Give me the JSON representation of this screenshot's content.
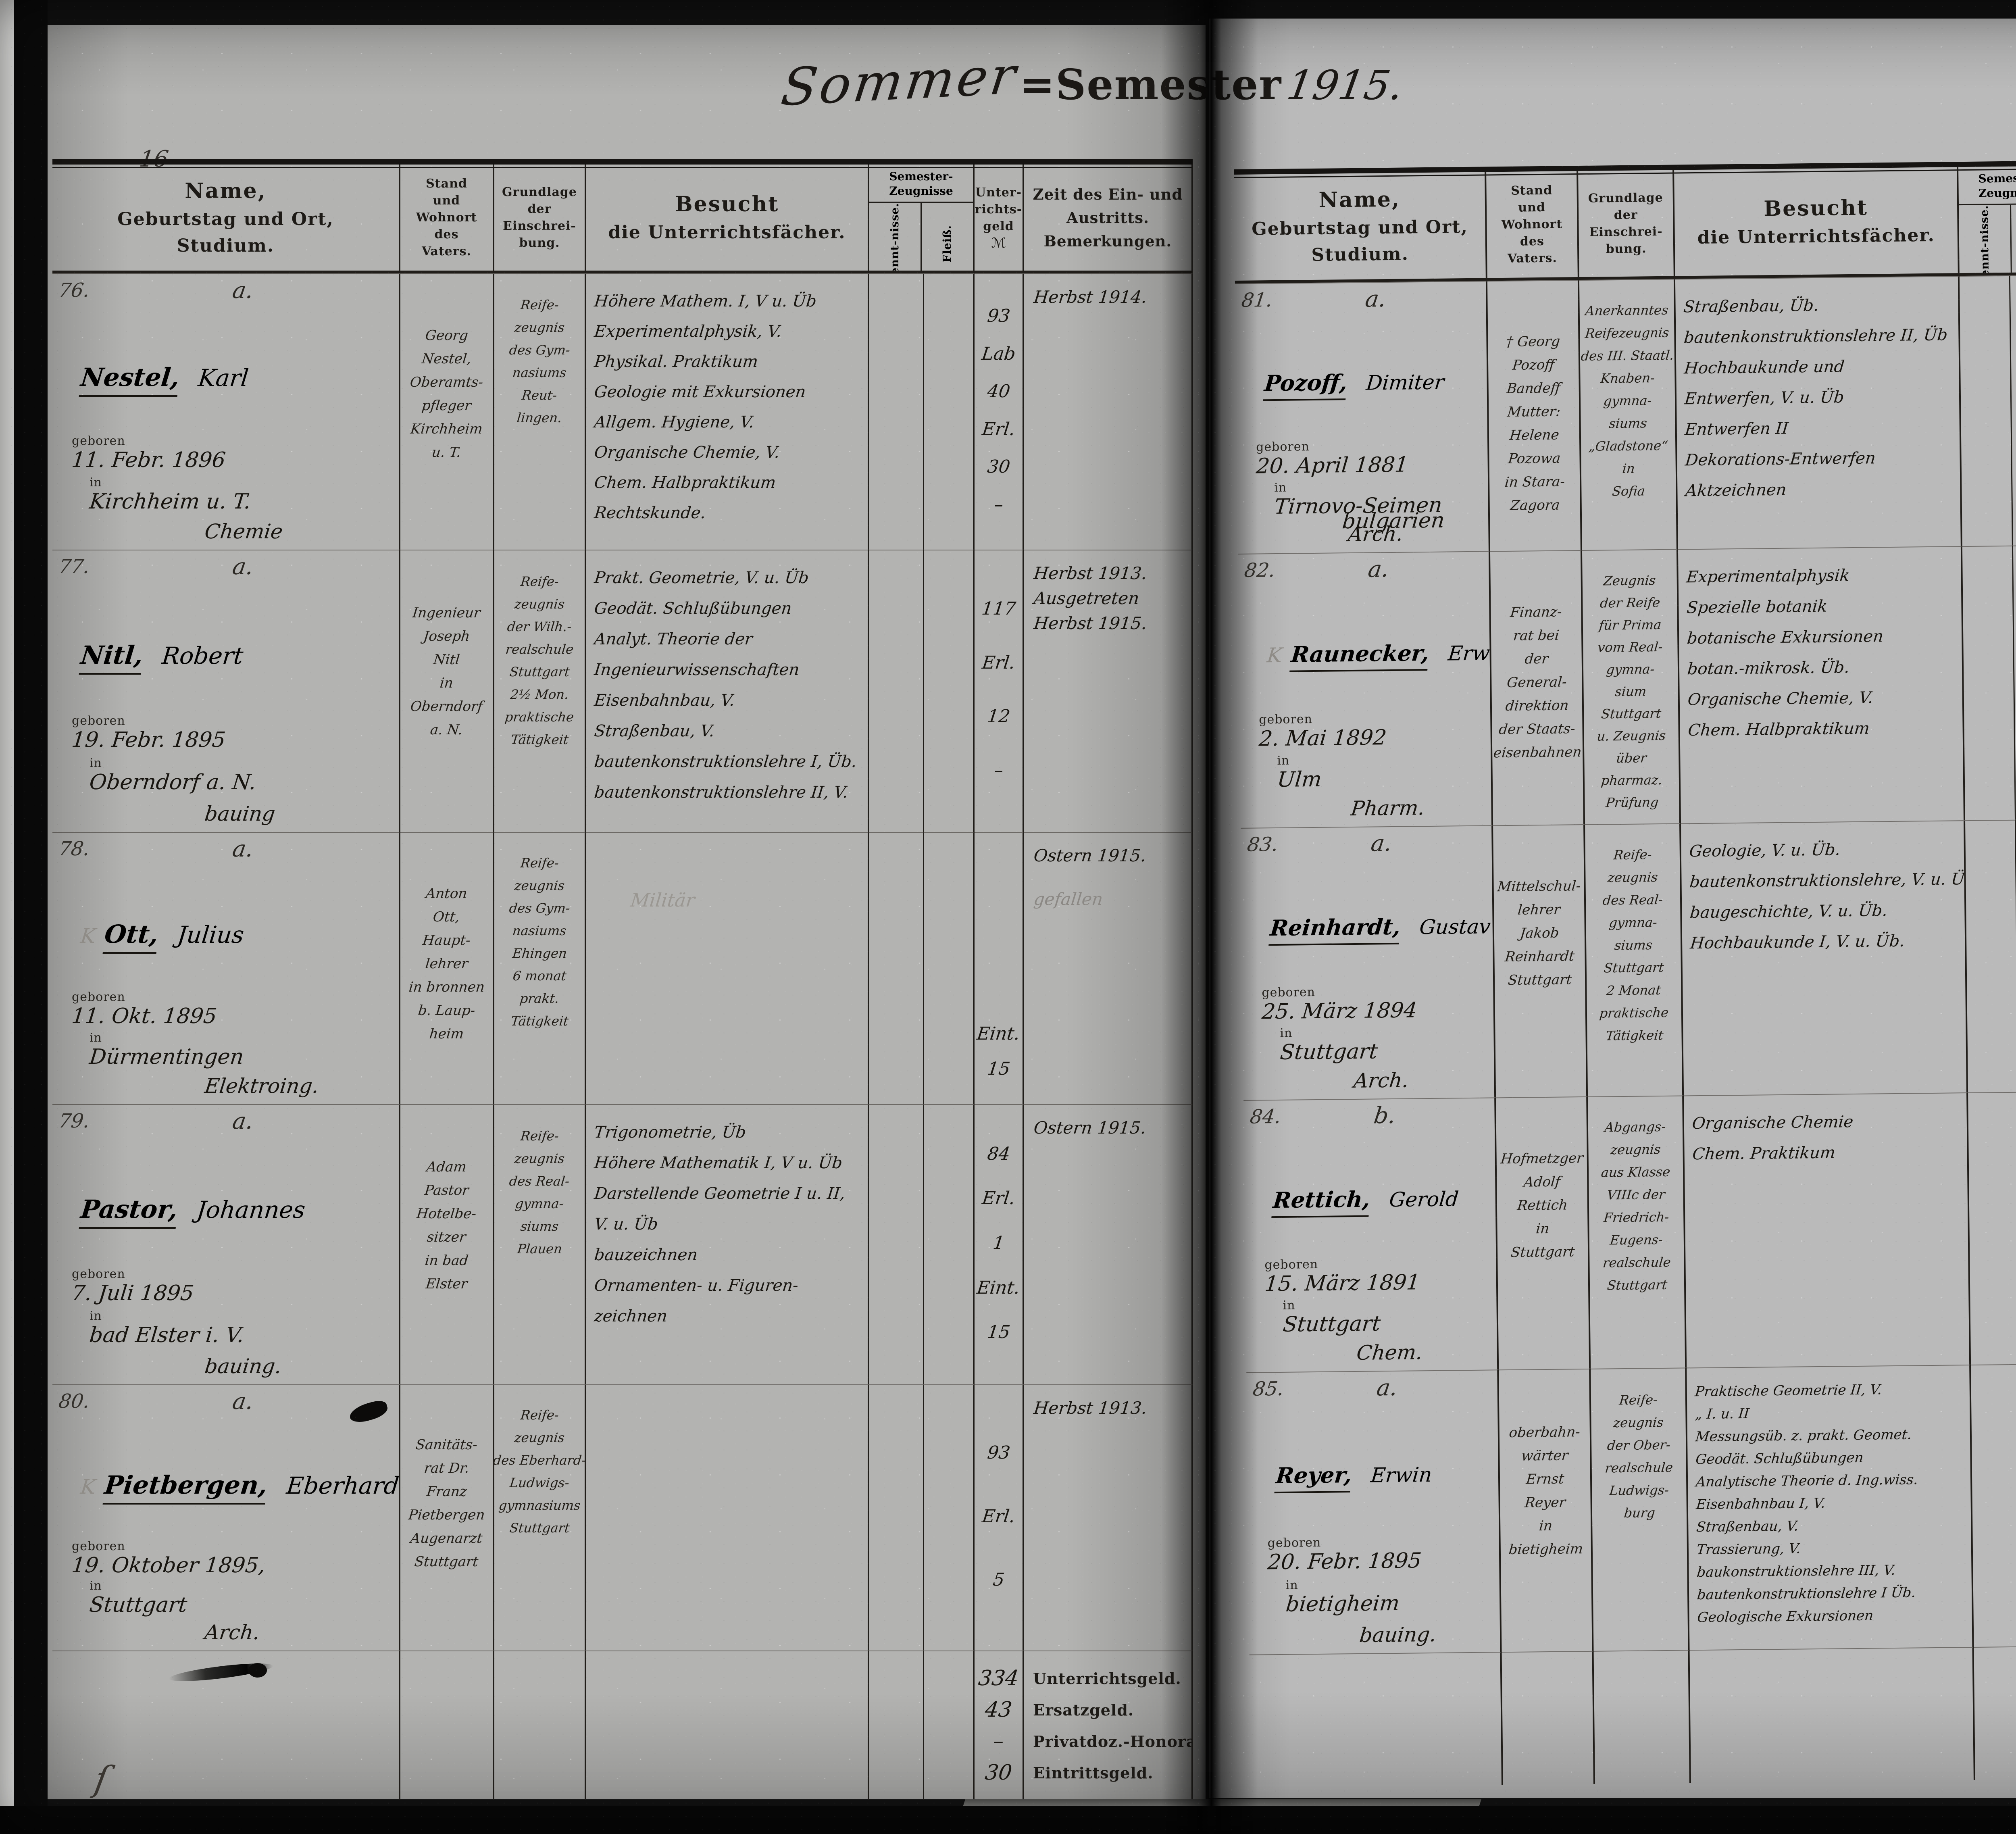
{
  "title": {
    "pre": "Sommer",
    "mid": "=Semester",
    "year": "1915."
  },
  "headers": {
    "name_lines": [
      "Name,",
      "Geburtstag und Ort,",
      "Studium."
    ],
    "stand_lines": [
      "Stand",
      "und",
      "Wohnort",
      "des",
      "Vaters."
    ],
    "grund_lines": [
      "Grundlage",
      "der",
      "Einschrei-",
      "bung."
    ],
    "besucht_lines": [
      "Besucht",
      "die Unterrichtsfächer."
    ],
    "zeug_lines": [
      "Semester-",
      "Zeugnisse"
    ],
    "kennt": "Kennt-nisse.",
    "fleiss": "Fleiß.",
    "geld_lines": [
      "Unter-",
      "richts-",
      "geld"
    ],
    "geld_currency": "ℳ",
    "zeit_lines": [
      "Zeit des Ein- und",
      "Austritts.",
      "Bemerkungen."
    ]
  },
  "pages": [
    {
      "page_number": "16",
      "entries": [
        {
          "number": "76.",
          "category": "a.",
          "surname": "Nestel,",
          "firstname": "Karl",
          "birth_label": "geboren",
          "birth_date": "11. Febr. 1896",
          "place_label": "in",
          "place": "Kirchheim u. T.",
          "study": "Chemie",
          "father": [
            "Georg",
            "Nestel,",
            "Oberamts-",
            "pfleger",
            "Kirchheim",
            "u. T."
          ],
          "grundlage": [
            "Reife-",
            "zeugnis",
            "des Gym-",
            "nasiums",
            "Reut-",
            "lingen."
          ],
          "subjects": [
            "Höhere Mathem. I, V u. Üb",
            "Experimentalphysik, V.",
            "Physikal. Praktikum",
            "Geologie mit Exkursionen",
            "Allgem. Hygiene, V.",
            "Organische Chemie, V.",
            "Chem. Halbpraktikum",
            "Rechtskunde."
          ],
          "fees": [
            {
              "t": "93"
            },
            {
              "t": "Lab"
            },
            {
              "t": "40"
            },
            {
              "t": "Erl."
            },
            {
              "t": "30"
            },
            {
              "t": "–"
            }
          ],
          "zeit": [
            {
              "t": "Herbst 1914."
            }
          ]
        },
        {
          "number": "77.",
          "category": "a.",
          "surname": "Nitl,",
          "firstname": "Robert",
          "birth_label": "geboren",
          "birth_date": "19. Febr. 1895",
          "place_label": "in",
          "place": "Oberndorf a. N.",
          "study": "bauing",
          "father": [
            "Ingenieur",
            "Joseph",
            "Nitl",
            "in",
            "Oberndorf",
            "a. N."
          ],
          "grundlage": [
            "Reife-",
            "zeugnis",
            "der Wilh.-",
            "realschule",
            "Stuttgart",
            "2½ Mon.",
            "praktische",
            "Tätigkeit"
          ],
          "subjects": [
            "Prakt. Geometrie, V. u. Üb",
            "Geodät. Schlußübungen",
            "Analyt. Theorie der",
            "Ingenieurwissenschaften",
            "Eisenbahnbau, V.",
            "Straßenbau, V.",
            "bautenkonstruktionslehre I, Üb.",
            "bautenkonstruktionslehre II, V."
          ],
          "fees": [
            {
              "t": "117"
            },
            {
              "t": "Erl."
            },
            {
              "t": "12"
            },
            {
              "t": "–"
            }
          ],
          "zeit": [
            {
              "t": "Herbst 1913."
            },
            {
              "t": "Ausgetreten"
            },
            {
              "t": "Herbst 1915."
            }
          ]
        },
        {
          "number": "78.",
          "category": "a.",
          "k_mark": "K",
          "surname": "Ott,",
          "firstname": "Julius",
          "birth_label": "geboren",
          "birth_date": "11. Okt. 1895",
          "place_label": "in",
          "place": "Dürmentingen",
          "study": "Elektroing.",
          "father": [
            "Anton",
            "Ott,",
            "Haupt-",
            "lehrer",
            "in bronnen",
            "b. Laup-",
            "heim"
          ],
          "grundlage": [
            "Reife-",
            "zeugnis",
            "des Gym-",
            "nasiums",
            "Ehingen",
            "6 monat",
            "prakt.",
            "Tätigkeit"
          ],
          "subjects": [],
          "subjects_pencil": "Militär",
          "fees": [
            {
              "t": "Eint."
            },
            {
              "t": "15"
            }
          ],
          "fees_justify": "flex-end",
          "zeit": [
            {
              "t": "Ostern 1915."
            },
            {
              "t": "gefallen",
              "pencil": true
            }
          ]
        },
        {
          "number": "79.",
          "category": "a.",
          "surname": "Pastor,",
          "firstname": "Johannes",
          "birth_label": "geboren",
          "birth_date": "7. Juli 1895",
          "place_label": "in",
          "place": "bad Elster i. V.",
          "study": "bauing.",
          "father": [
            "Adam",
            "Pastor",
            "Hotelbe-",
            "sitzer",
            "in bad",
            "Elster"
          ],
          "grundlage": [
            "Reife-",
            "zeugnis",
            "des Real-",
            "gymna-",
            "siums",
            "Plauen"
          ],
          "subjects": [
            "Trigonometrie, Üb",
            "Höhere Mathematik I, V u. Üb",
            "Darstellende Geometrie I u. II,",
            "V. u. Üb",
            "bauzeichnen",
            "Ornamenten- u. Figuren-",
            "zeichnen"
          ],
          "fees": [
            {
              "t": "84"
            },
            {
              "t": "Erl."
            },
            {
              "t": "1"
            },
            {
              "t": "Eint."
            },
            {
              "t": "15"
            }
          ],
          "zeit": [
            {
              "t": "Ostern 1915."
            }
          ]
        },
        {
          "number": "80.",
          "category": "a.",
          "k_mark": "K",
          "surname": "Pietbergen,",
          "firstname": "Eberhard",
          "birth_label": "geboren",
          "birth_date": "19. Oktober 1895,",
          "place_label": "in",
          "place": "Stuttgart",
          "study": "Arch.",
          "father": [
            "Sanitäts-",
            "rat Dr.",
            "Franz",
            "Pietbergen",
            "Augenarzt",
            "Stuttgart"
          ],
          "grundlage": [
            "Reife-",
            "zeugnis",
            "des Eberhard-",
            "Ludwigs-",
            "gymnasiums",
            "Stuttgart"
          ],
          "subjects": [],
          "fees": [
            {
              "t": "93"
            },
            {
              "t": "Erl."
            },
            {
              "t": "5"
            }
          ],
          "zeit": [
            {
              "t": "Herbst 1913."
            }
          ]
        }
      ],
      "totals": [
        {
          "amount": "334",
          "label": "Unterrichtsgeld."
        },
        {
          "amount": "43",
          "label": "Ersatzgeld."
        },
        {
          "amount": "–",
          "label": "Privatdoz.-Honorar."
        },
        {
          "amount": "30",
          "label": "Eintrittsgeld."
        }
      ]
    },
    {
      "page_number": "17",
      "entries": [
        {
          "number": "81.",
          "category": "a.",
          "surname": "Pozoff,",
          "firstname": "Dimiter",
          "birth_label": "geboren",
          "birth_date": "20. April 1881",
          "place_label": "in",
          "place": "Tirnovo-Seimen",
          "place2": "bulgarien",
          "study": "Arch.",
          "father": [
            "† Georg",
            "Pozoff",
            "Bandeff",
            "Mutter:",
            "Helene",
            "Pozowa",
            "in Stara-",
            "Zagora"
          ],
          "grundlage": [
            "Anerkanntes",
            "Reifezeugnis",
            "des III. Staatl.",
            "Knaben-",
            "gymna-",
            "siums",
            "„Gladstone“",
            "in",
            "Sofia"
          ],
          "subjects": [
            "Straßenbau, Üb.",
            "bautenkonstruktionslehre II, Üb",
            "Hochbaukunde und",
            "Entwerfen, V. u. Üb",
            "Entwerfen II",
            "Dekorations-Entwerfen",
            "Aktzeichnen"
          ],
          "fees": [
            {
              "t": "146"
            },
            {
              "t": "Erl."
            },
            {
              "t": "2"
            }
          ],
          "zeit": [
            {
              "t": "Herbst 1910/12;"
            },
            {
              "t": "wieder"
            },
            {
              "t": "Herbst 1913."
            },
            {
              "t": "Ausgetreten"
            },
            {
              "t": "Herbst 1915"
            }
          ]
        },
        {
          "number": "82.",
          "category": "a.",
          "k_mark": "K",
          "surname": "Raunecker,",
          "firstname": "Erwin",
          "birth_label": "geboren",
          "birth_date": "2. Mai 1892",
          "place_label": "in",
          "place": "Ulm",
          "study": "Pharm.",
          "father": [
            "Finanz-",
            "rat bei",
            "der",
            "General-",
            "direktion",
            "der Staats-",
            "eisenbahnen"
          ],
          "grundlage": [
            "Zeugnis",
            "der Reife",
            "für Prima",
            "vom Real-",
            "gymna-",
            "sium",
            "Stuttgart",
            "u. Zeugnis",
            "über",
            "pharmaz.",
            "Prüfung"
          ],
          "subjects": [
            "Experimentalphysik",
            "Spezielle botanik",
            "botanische Exkursionen",
            "botan.-mikrosk. Üb.",
            "Organische Chemie, V.",
            "Chem. Halbpraktikum"
          ],
          "fees": [
            {
              "t": "64",
              "struck": true
            },
            {
              "t": "Lab",
              "struck": true
            },
            {
              "t": "40",
              "struck": true
            },
            {
              "t": "Erl.",
              "struck": true
            },
            {
              "t": "24",
              "struck": true
            }
          ],
          "zeit": [
            {
              "t": "Herbst 1914."
            }
          ]
        },
        {
          "number": "83.",
          "category": "a.",
          "surname": "Reinhardt,",
          "firstname": "Gustav",
          "birth_label": "geboren",
          "birth_date": "25. März 1894",
          "place_label": "in",
          "place": "Stuttgart",
          "study": "Arch.",
          "father": [
            "Mittelschul-",
            "lehrer",
            "Jakob",
            "Reinhardt",
            "Stuttgart"
          ],
          "grundlage": [
            "Reife-",
            "zeugnis",
            "des Real-",
            "gymna-",
            "siums",
            "Stuttgart",
            "2 Monat",
            "praktische",
            "Tätigkeit"
          ],
          "subjects": [
            "Geologie, V. u. Üb.",
            "bautenkonstruktionslehre, V. u. Üb.",
            "baugeschichte, V. u. Üb.",
            "Hochbaukunde I, V. u. Üb."
          ],
          "fees": [
            {
              "t": "80"
            }
          ],
          "fees_justify": "flex-start",
          "zeit": [
            {
              "t": "Herbst 1913."
            },
            {
              "t": "Ausgetreten"
            },
            {
              "t": "Herbst 1915"
            },
            {
              "t": "…. H. 1915",
              "pencil": true
            }
          ]
        },
        {
          "number": "84.",
          "category": "b.",
          "surname": "Rettich,",
          "firstname": "Gerold",
          "birth_label": "geboren",
          "birth_date": "15. März 1891",
          "place_label": "in",
          "place": "Stuttgart",
          "study": "Chem.",
          "father": [
            "Hofmetzger",
            "Adolf",
            "Rettich",
            "in",
            "Stuttgart"
          ],
          "grundlage": [
            "Abgangs-",
            "zeugnis",
            "aus Klasse",
            "VIIIc der",
            "Friedrich-",
            "Eugens-",
            "realschule",
            "Stuttgart"
          ],
          "subjects": [
            "Organische Chemie",
            "Chem. Praktikum"
          ],
          "fees": [
            {
              "t": "15"
            },
            {
              "t": "Lab"
            },
            {
              "t": "75"
            },
            {
              "t": "Erl."
            },
            {
              "t": "30"
            },
            {
              "t": "–"
            }
          ],
          "zeit": [
            {
              "t": "Herbst 1910/11"
            },
            {
              "t": "Naturw."
            },
            {
              "t": "wieder"
            },
            {
              "t": "Herbst 1912 Chemie."
            }
          ]
        },
        {
          "number": "85.",
          "category": "a.",
          "surname": "Reyer,",
          "firstname": "Erwin",
          "birth_label": "geboren",
          "birth_date": "20. Febr. 1895",
          "place_label": "in",
          "place": "bietigheim",
          "study": "bauing.",
          "father": [
            "oberbahn-",
            "wärter",
            "Ernst",
            "Reyer",
            "in",
            "bietigheim"
          ],
          "grundlage": [
            "Reife-",
            "zeugnis",
            "der Ober-",
            "realschule",
            "Ludwigs-",
            "burg"
          ],
          "subjects": [
            "Praktische Geometrie II, V.",
            "„  I. u. II",
            "Messungsüb. z. prakt. Geomet.",
            "Geodät. Schlußübungen",
            "Analytische Theorie d. Ing.wiss.",
            "Eisenbahnbau I, V.",
            "Straßenbau, V.",
            "Trassierung, V.",
            "baukonstruktionslehre III, V.",
            "bautenkonstruktionslehre I Üb.",
            "Geologische Exkursionen"
          ],
          "fees": [
            {
              "t": "126"
            },
            {
              "t": "Erl."
            },
            {
              "t": "12"
            }
          ],
          "zeit": [
            {
              "t": "Herbst 1913."
            }
          ]
        }
      ],
      "totals": [
        {
          "amount": "742",
          "label": "Unterrichtsgeld."
        },
        {
          "amount": "44",
          "label": "Ersatzgeld."
        },
        {
          "amount": "–",
          "label": "Privatdoz.-Honorar."
        },
        {
          "amount": "–",
          "label": "Eintrittsgeld."
        }
      ]
    }
  ]
}
